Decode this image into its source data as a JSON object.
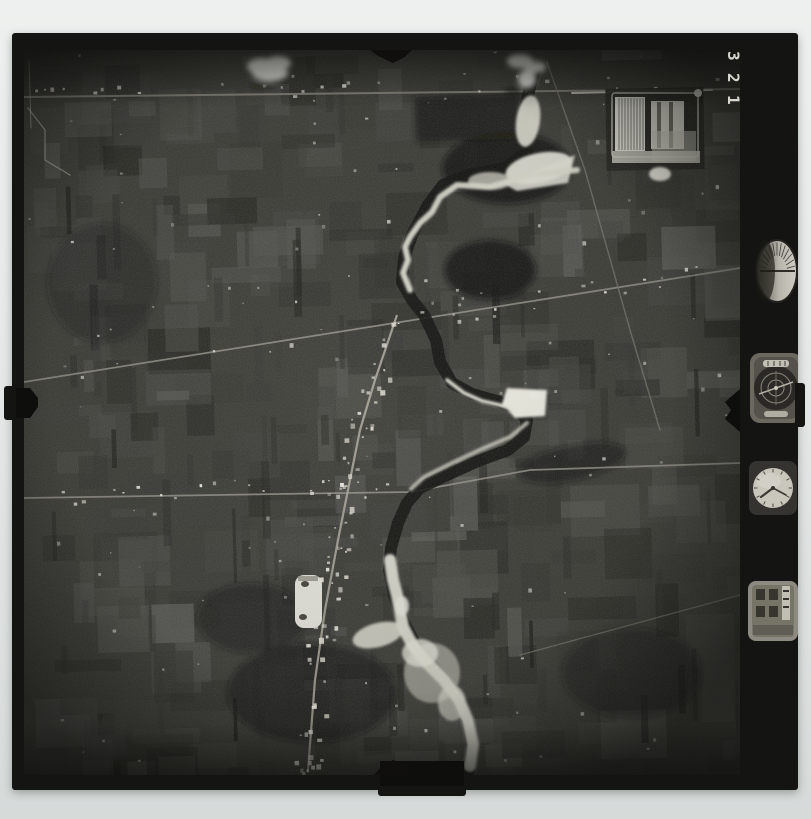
{
  "frame_number": {
    "digits": [
      "3",
      "2",
      "1"
    ]
  },
  "colors": {
    "scan_background": "#e6e9e8",
    "print_black": "#141412",
    "image_base": "#3b3b36",
    "water_dark": "#0e0e0c",
    "sand": "#e2e2d6",
    "sand_bright": "#eeeee4",
    "road": "#8f8d82",
    "cloud_white": "#f5f5f0",
    "dial_face": "#c9c6bc",
    "digit_white": "#e7e7df"
  },
  "instruments": {
    "altimeter": "altimeter-dial",
    "level": "level-indicator-dial",
    "clock": "clock-dial",
    "counter": "frame-counter-panel"
  }
}
